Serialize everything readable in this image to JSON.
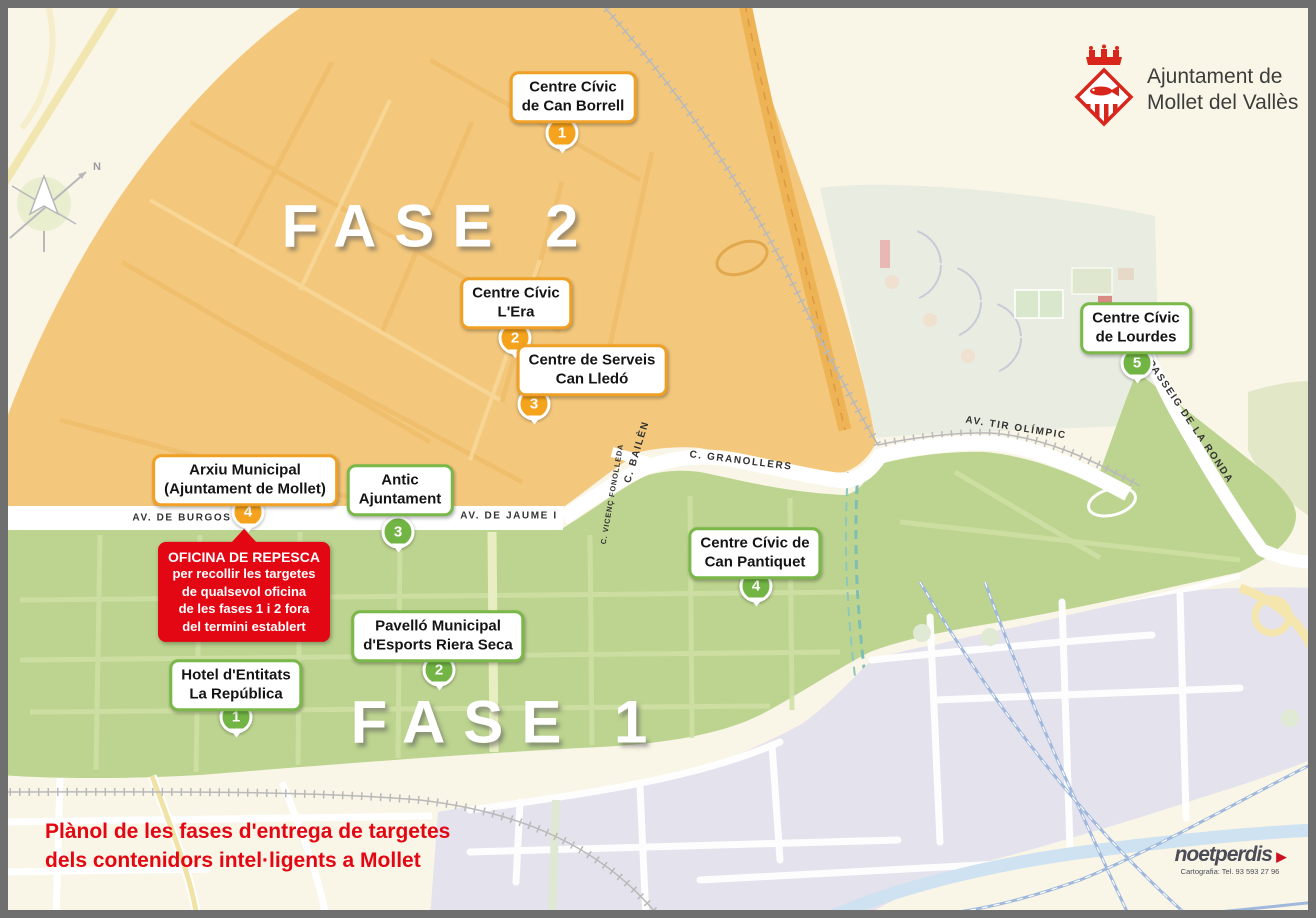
{
  "title": {
    "line1": "Plànol de les fases d'entrega de targetes",
    "line2": "dels contenidors intel·ligents a Mollet",
    "color": "#e30613"
  },
  "logo": {
    "line1": "Ajuntament de",
    "line2": "Mollet del Vallès",
    "crest_color": "#d9261c"
  },
  "zones": {
    "fase1": {
      "label": "FASE 1",
      "fill": "#bcd48f",
      "accent": "#72b544"
    },
    "fase2": {
      "label": "FASE 2",
      "fill": "#f4c87c",
      "accent": "#f5a31c"
    }
  },
  "locations": [
    {
      "phase": "2",
      "number": "1",
      "name": "Centre Cívic\nde Can Borrell"
    },
    {
      "phase": "2",
      "number": "2",
      "name": "Centre Cívic\nL'Era"
    },
    {
      "phase": "2",
      "number": "3",
      "name": "Centre de Serveis\nCan Lledó"
    },
    {
      "phase": "2",
      "number": "4",
      "name": "Arxiu Municipal\n(Ajuntament de Mollet)"
    },
    {
      "phase": "1",
      "number": "1",
      "name": "Hotel d'Entitats\nLa República"
    },
    {
      "phase": "1",
      "number": "2",
      "name": "Pavelló Municipal\nd'Esports Riera Seca"
    },
    {
      "phase": "1",
      "number": "3",
      "name": "Antic\nAjuntament"
    },
    {
      "phase": "1",
      "number": "4",
      "name": "Centre Cívic de\nCan Pantiquet"
    },
    {
      "phase": "1",
      "number": "5",
      "name": "Centre Cívic\nde Lourdes"
    }
  ],
  "repesca": {
    "title": "OFICINA DE REPESCA",
    "lines": "per recollir les targetes\nde qualsevol oficina\nde les fases 1 i 2 fora\ndel termini establert",
    "color": "#e30613"
  },
  "streets": {
    "burgos": "AV. DE BURGOS",
    "jaume": "AV. DE JAUME I",
    "bailen": "C. BAILÈN",
    "fonolleda": "C. VICENÇ FONOLLEDA",
    "granollers": "C. GRANOLLERS",
    "tir_olimpic": "AV. TIR OLÍMPIC",
    "ronda": "PASSEIG DE LA RONDA"
  },
  "compass": {
    "label": "N"
  },
  "credit": {
    "brand": "noetperdis",
    "arrow": "▶",
    "line": "Cartografia: Tel. 93 593 27 96"
  }
}
